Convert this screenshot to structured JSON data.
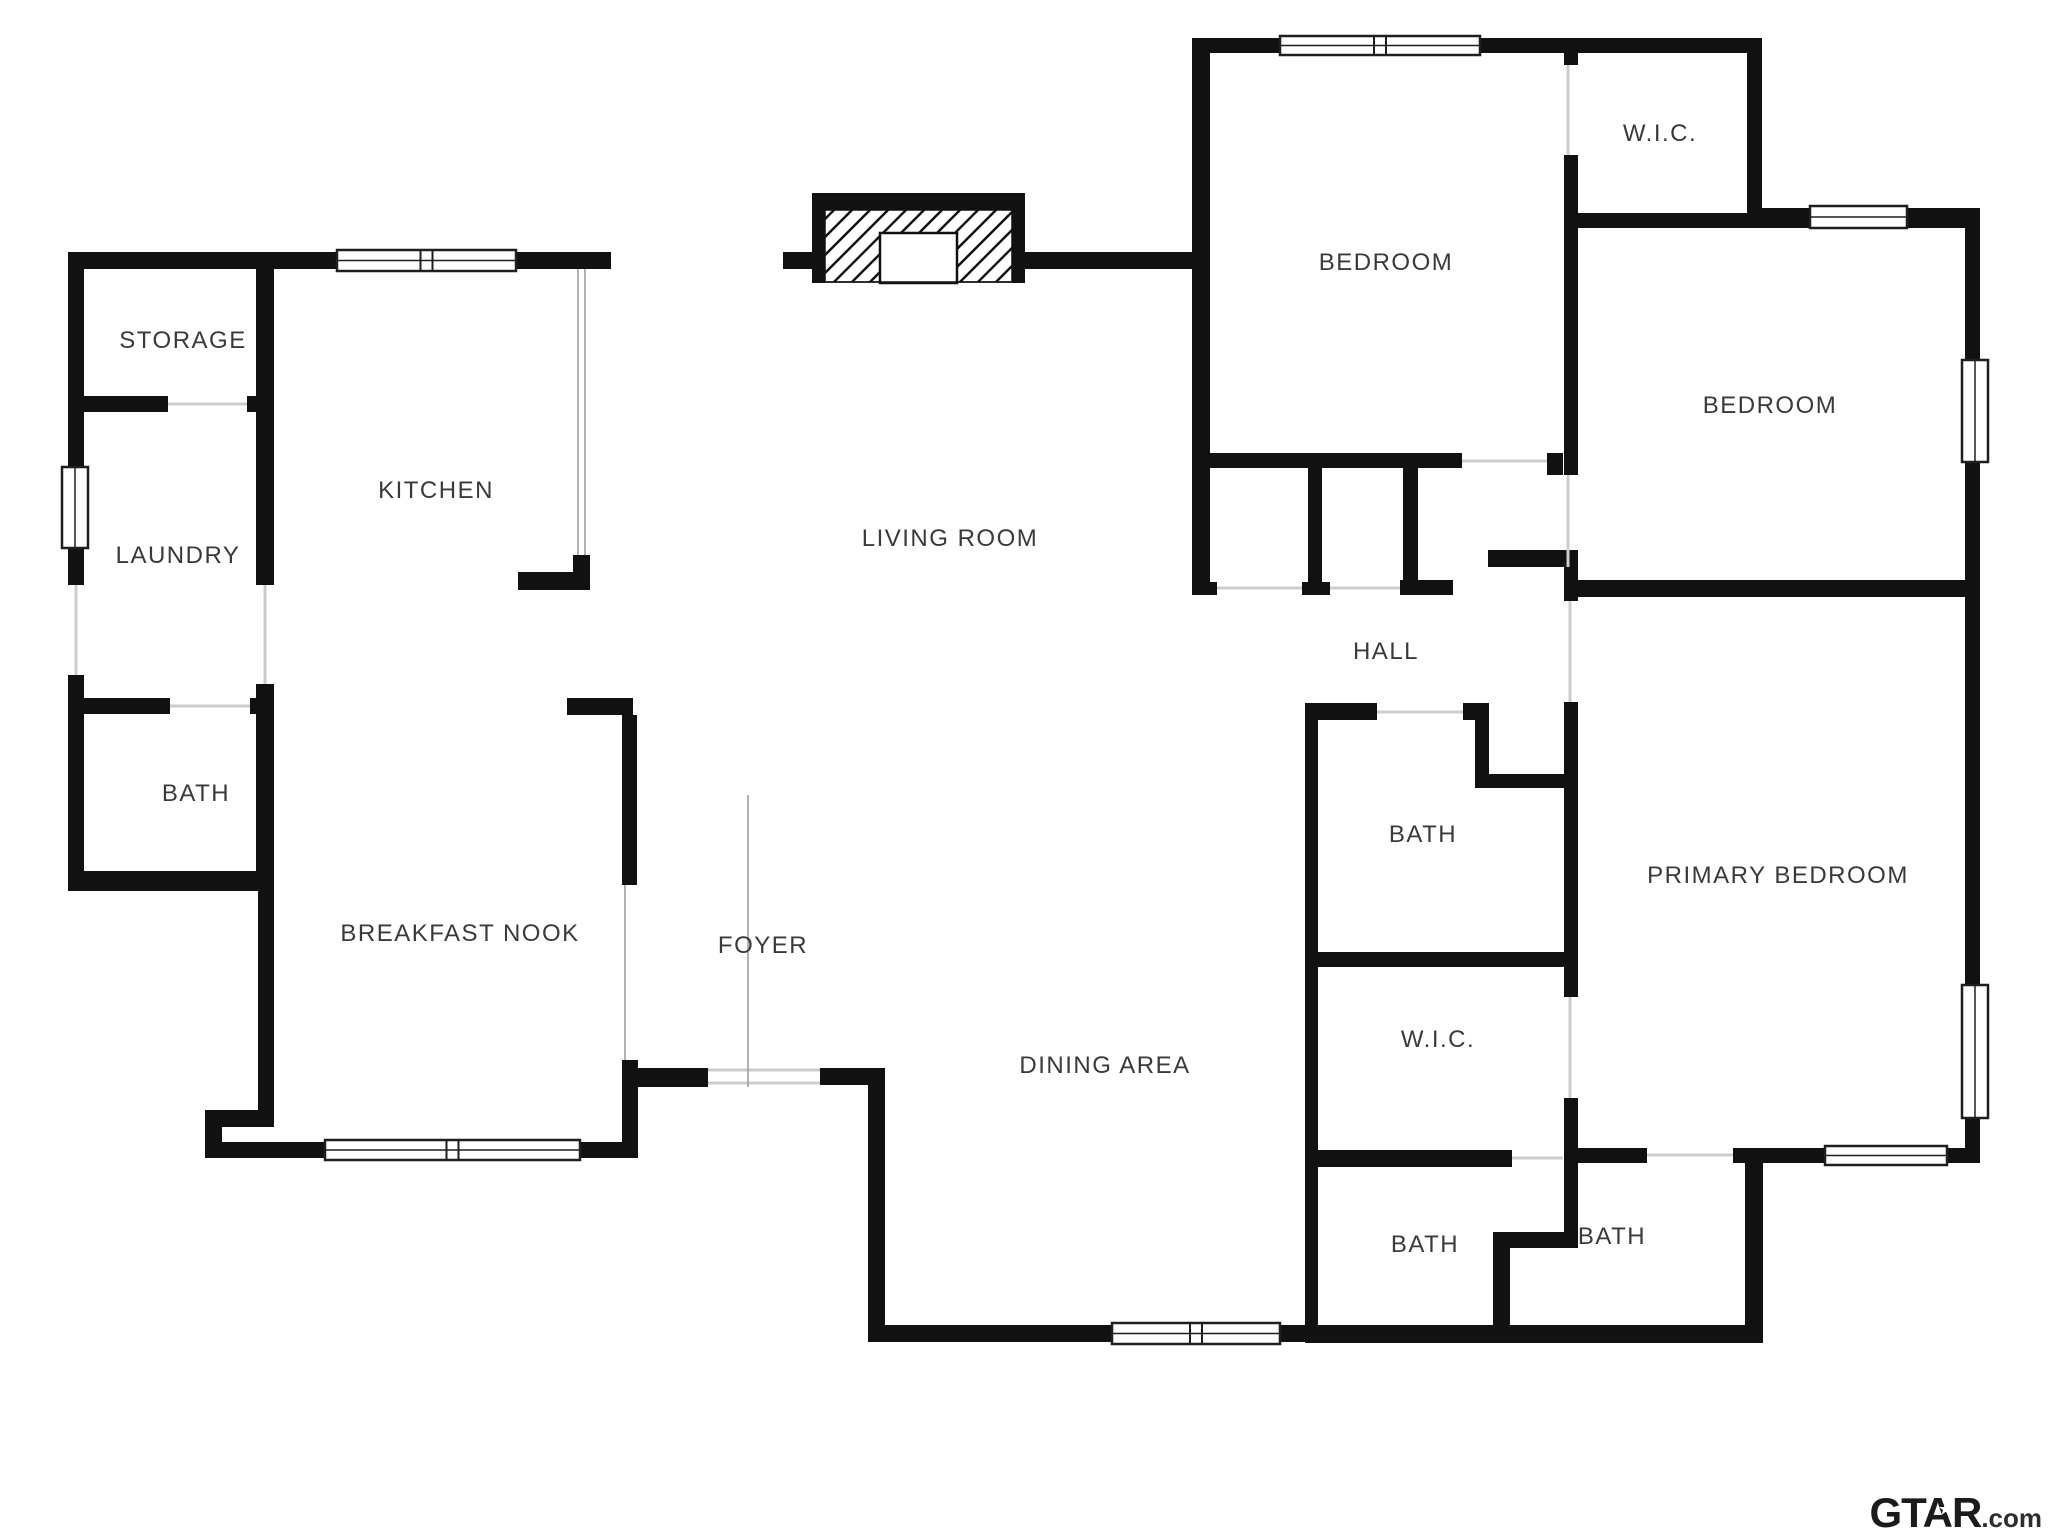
{
  "plan_title": "single-story house floor plan",
  "colors": {
    "wall": "#111111",
    "label_text": "#3a3a3a",
    "window_frame": "#1f1f1f",
    "door_threshold": "#cccccc",
    "thin_divider": "#9a9a9a",
    "watermark": "#1b1b1b"
  },
  "rooms": [
    {
      "name": "STORAGE",
      "x": 183,
      "y": 341
    },
    {
      "name": "KITCHEN",
      "x": 436,
      "y": 491
    },
    {
      "name": "LAUNDRY",
      "x": 178,
      "y": 556
    },
    {
      "name": "LIVING ROOM",
      "x": 950,
      "y": 539
    },
    {
      "name": "BATH",
      "x": 196,
      "y": 794
    },
    {
      "name": "BREAKFAST NOOK",
      "x": 460,
      "y": 934
    },
    {
      "name": "FOYER",
      "x": 763,
      "y": 946
    },
    {
      "name": "DINING AREA",
      "x": 1105,
      "y": 1066
    },
    {
      "name": "HALL",
      "x": 1386,
      "y": 652
    },
    {
      "name": "BEDROOM",
      "x": 1386,
      "y": 263
    },
    {
      "name": "W.I.C.",
      "x": 1660,
      "y": 134
    },
    {
      "name": "BEDROOM",
      "x": 1770,
      "y": 406
    },
    {
      "name": "PRIMARY BEDROOM",
      "x": 1778,
      "y": 876
    },
    {
      "name": "BATH",
      "x": 1423,
      "y": 835
    },
    {
      "name": "W.I.C.",
      "x": 1438,
      "y": 1040
    },
    {
      "name": "BATH",
      "x": 1425,
      "y": 1245
    },
    {
      "name": "BATH",
      "x": 1612,
      "y": 1237
    }
  ],
  "watermark": {
    "brand": "GTAR",
    "star": "★",
    "suffix": ".com"
  },
  "geometry": {
    "walls": [
      [
        68,
        252,
        16,
        215
      ],
      [
        68,
        548,
        16,
        37
      ],
      [
        68,
        675,
        16,
        216
      ],
      [
        68,
        252,
        269,
        17
      ],
      [
        516,
        252,
        95,
        17
      ],
      [
        783,
        252,
        29,
        17
      ],
      [
        1025,
        252,
        170,
        17
      ],
      [
        68,
        396,
        100,
        16
      ],
      [
        247,
        396,
        27,
        16
      ],
      [
        68,
        698,
        102,
        16
      ],
      [
        250,
        698,
        24,
        16
      ],
      [
        256,
        268,
        18,
        317
      ],
      [
        256,
        684,
        18,
        207
      ],
      [
        68,
        871,
        192,
        20
      ],
      [
        258,
        891,
        16,
        236
      ],
      [
        205,
        1110,
        69,
        17
      ],
      [
        205,
        1127,
        17,
        31
      ],
      [
        205,
        1142,
        120,
        16
      ],
      [
        580,
        1142,
        58,
        16
      ],
      [
        518,
        572,
        72,
        18
      ],
      [
        573,
        555,
        17,
        17
      ],
      [
        567,
        698,
        66,
        17
      ],
      [
        622,
        715,
        15,
        170
      ],
      [
        622,
        1060,
        16,
        98
      ],
      [
        633,
        1068,
        75,
        19
      ],
      [
        820,
        1068,
        65,
        17
      ],
      [
        868,
        1085,
        17,
        257
      ],
      [
        868,
        1325,
        244,
        17
      ],
      [
        1280,
        1325,
        38,
        17
      ],
      [
        1305,
        1325,
        458,
        18
      ],
      [
        1192,
        38,
        18,
        557
      ],
      [
        1192,
        38,
        88,
        15
      ],
      [
        1480,
        38,
        282,
        15
      ],
      [
        1308,
        468,
        14,
        115
      ],
      [
        1403,
        455,
        15,
        128
      ],
      [
        1192,
        582,
        25,
        13
      ],
      [
        1302,
        582,
        28,
        13
      ],
      [
        1400,
        580,
        53,
        15
      ],
      [
        1192,
        453,
        270,
        15
      ],
      [
        1547,
        453,
        16,
        22
      ],
      [
        1488,
        550,
        90,
        17
      ],
      [
        1564,
        53,
        14,
        12
      ],
      [
        1564,
        155,
        14,
        320
      ],
      [
        1564,
        567,
        14,
        34
      ],
      [
        1564,
        702,
        14,
        295
      ],
      [
        1564,
        1098,
        14,
        150
      ],
      [
        1493,
        1232,
        85,
        16
      ],
      [
        1493,
        1248,
        17,
        94
      ],
      [
        1564,
        213,
        198,
        15
      ],
      [
        1747,
        38,
        15,
        190
      ],
      [
        1762,
        208,
        48,
        20
      ],
      [
        1907,
        208,
        73,
        20
      ],
      [
        1965,
        228,
        15,
        132
      ],
      [
        1965,
        460,
        15,
        137
      ],
      [
        1965,
        597,
        15,
        388
      ],
      [
        1965,
        1118,
        15,
        45
      ],
      [
        1578,
        580,
        387,
        17
      ],
      [
        1305,
        703,
        72,
        17
      ],
      [
        1463,
        703,
        26,
        17
      ],
      [
        1475,
        714,
        14,
        74
      ],
      [
        1475,
        774,
        90,
        14
      ],
      [
        1305,
        703,
        13,
        264
      ],
      [
        1305,
        952,
        260,
        15
      ],
      [
        1305,
        967,
        13,
        183
      ],
      [
        1305,
        1150,
        207,
        17
      ],
      [
        1305,
        1167,
        13,
        175
      ],
      [
        1578,
        1148,
        69,
        15
      ],
      [
        1733,
        1148,
        92,
        15
      ],
      [
        1947,
        1148,
        33,
        15
      ],
      [
        1745,
        1163,
        18,
        180
      ]
    ],
    "windows": [
      {
        "x": 337,
        "y": 250,
        "w": 179,
        "h": 21,
        "o": "h",
        "d": true
      },
      {
        "x": 62,
        "y": 467,
        "w": 26,
        "h": 81,
        "o": "v",
        "d": false
      },
      {
        "x": 325,
        "y": 1140,
        "w": 255,
        "h": 20,
        "o": "h",
        "d": true
      },
      {
        "x": 1112,
        "y": 1323,
        "w": 168,
        "h": 21,
        "o": "h",
        "d": true
      },
      {
        "x": 1280,
        "y": 36,
        "w": 200,
        "h": 19,
        "o": "h",
        "d": true
      },
      {
        "x": 1810,
        "y": 206,
        "w": 97,
        "h": 22,
        "o": "h",
        "d": false
      },
      {
        "x": 1962,
        "y": 360,
        "w": 26,
        "h": 102,
        "o": "v",
        "d": false
      },
      {
        "x": 1962,
        "y": 985,
        "w": 26,
        "h": 133,
        "o": "v",
        "d": false
      },
      {
        "x": 1825,
        "y": 1146,
        "w": 122,
        "h": 19,
        "o": "h",
        "d": false
      }
    ],
    "thresholds": [
      [
        168,
        404,
        247,
        404
      ],
      [
        76,
        585,
        76,
        675
      ],
      [
        265,
        585,
        265,
        684
      ],
      [
        170,
        706,
        250,
        706
      ],
      [
        1217,
        588,
        1302,
        588
      ],
      [
        1330,
        588,
        1400,
        588
      ],
      [
        1462,
        461,
        1547,
        461
      ],
      [
        1568,
        475,
        1568,
        567
      ],
      [
        1570,
        601,
        1570,
        702
      ],
      [
        1568,
        65,
        1568,
        155
      ],
      [
        1570,
        997,
        1570,
        1098
      ],
      [
        1377,
        712,
        1463,
        712
      ],
      [
        1647,
        1155,
        1733,
        1155
      ],
      [
        1512,
        1158,
        1563,
        1158
      ],
      [
        708,
        1070,
        820,
        1070
      ],
      [
        708,
        1083,
        820,
        1083
      ]
    ],
    "thin_lines": [
      [
        578,
        269,
        578,
        555
      ],
      [
        585,
        269,
        585,
        555
      ],
      [
        625,
        885,
        625,
        1060
      ],
      [
        748,
        795,
        748,
        1087
      ]
    ],
    "fireplace": {
      "top": [
        812,
        193,
        213,
        17
      ],
      "left": [
        812,
        193,
        13,
        90
      ],
      "right": [
        1012,
        193,
        13,
        90
      ],
      "hatch": [
        825,
        210,
        187,
        72
      ],
      "firebox": [
        880,
        233,
        77,
        50
      ],
      "base_line": [
        825,
        282,
        1012,
        282
      ]
    }
  }
}
